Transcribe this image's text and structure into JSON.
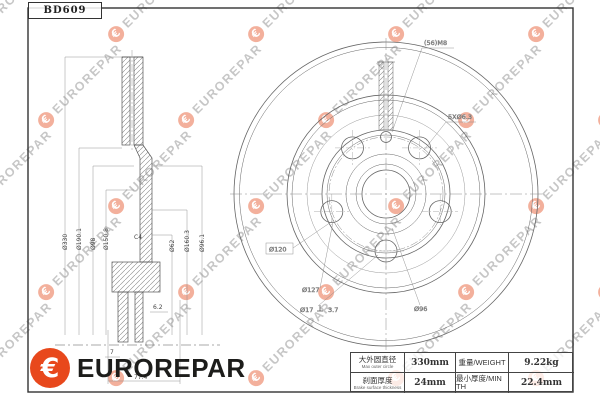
{
  "title_box": {
    "part_number": "BD609"
  },
  "watermark": {
    "text": "EUROREPAR"
  },
  "logo": {
    "brand": "EUROREPAR"
  },
  "colors": {
    "brand_orange": "#E8481C",
    "line": "#555555",
    "watermark_gray": "#8F8F8F"
  },
  "section_view": {
    "diameter_labels": [
      "Ø330",
      "Ø190.1",
      "Ø98",
      "Ø150.8",
      "Ø62",
      "Ø160.3",
      "Ø96.1"
    ],
    "chamfer_label": "C4",
    "width_dims": {
      "pilot": "7",
      "total_height": "77.4",
      "offset": "6.2"
    }
  },
  "front_view": {
    "set_screw_label": "(56)M8",
    "bolt_hole_count_label": "5XØ6.3",
    "bolt_circle_label": "Ø120",
    "inner_diameter_label": "Ø127",
    "bolt_hole_diameter_label": "Ø17",
    "depth_label": "3.7",
    "hub_diameter_label": "Ø96"
  },
  "spec_table": {
    "rows": [
      {
        "label_cn": "大外圆直径",
        "label_en": "Max outer circle",
        "value": "330mm",
        "label2": "重量/WEIGHT",
        "value2": "9.22kg"
      },
      {
        "label_cn": "刹面厚度",
        "label_en": "Brake surface thickness",
        "value": "24mm",
        "label2": "最小厚度/MIN TH",
        "value2": "22.4mm"
      }
    ]
  }
}
